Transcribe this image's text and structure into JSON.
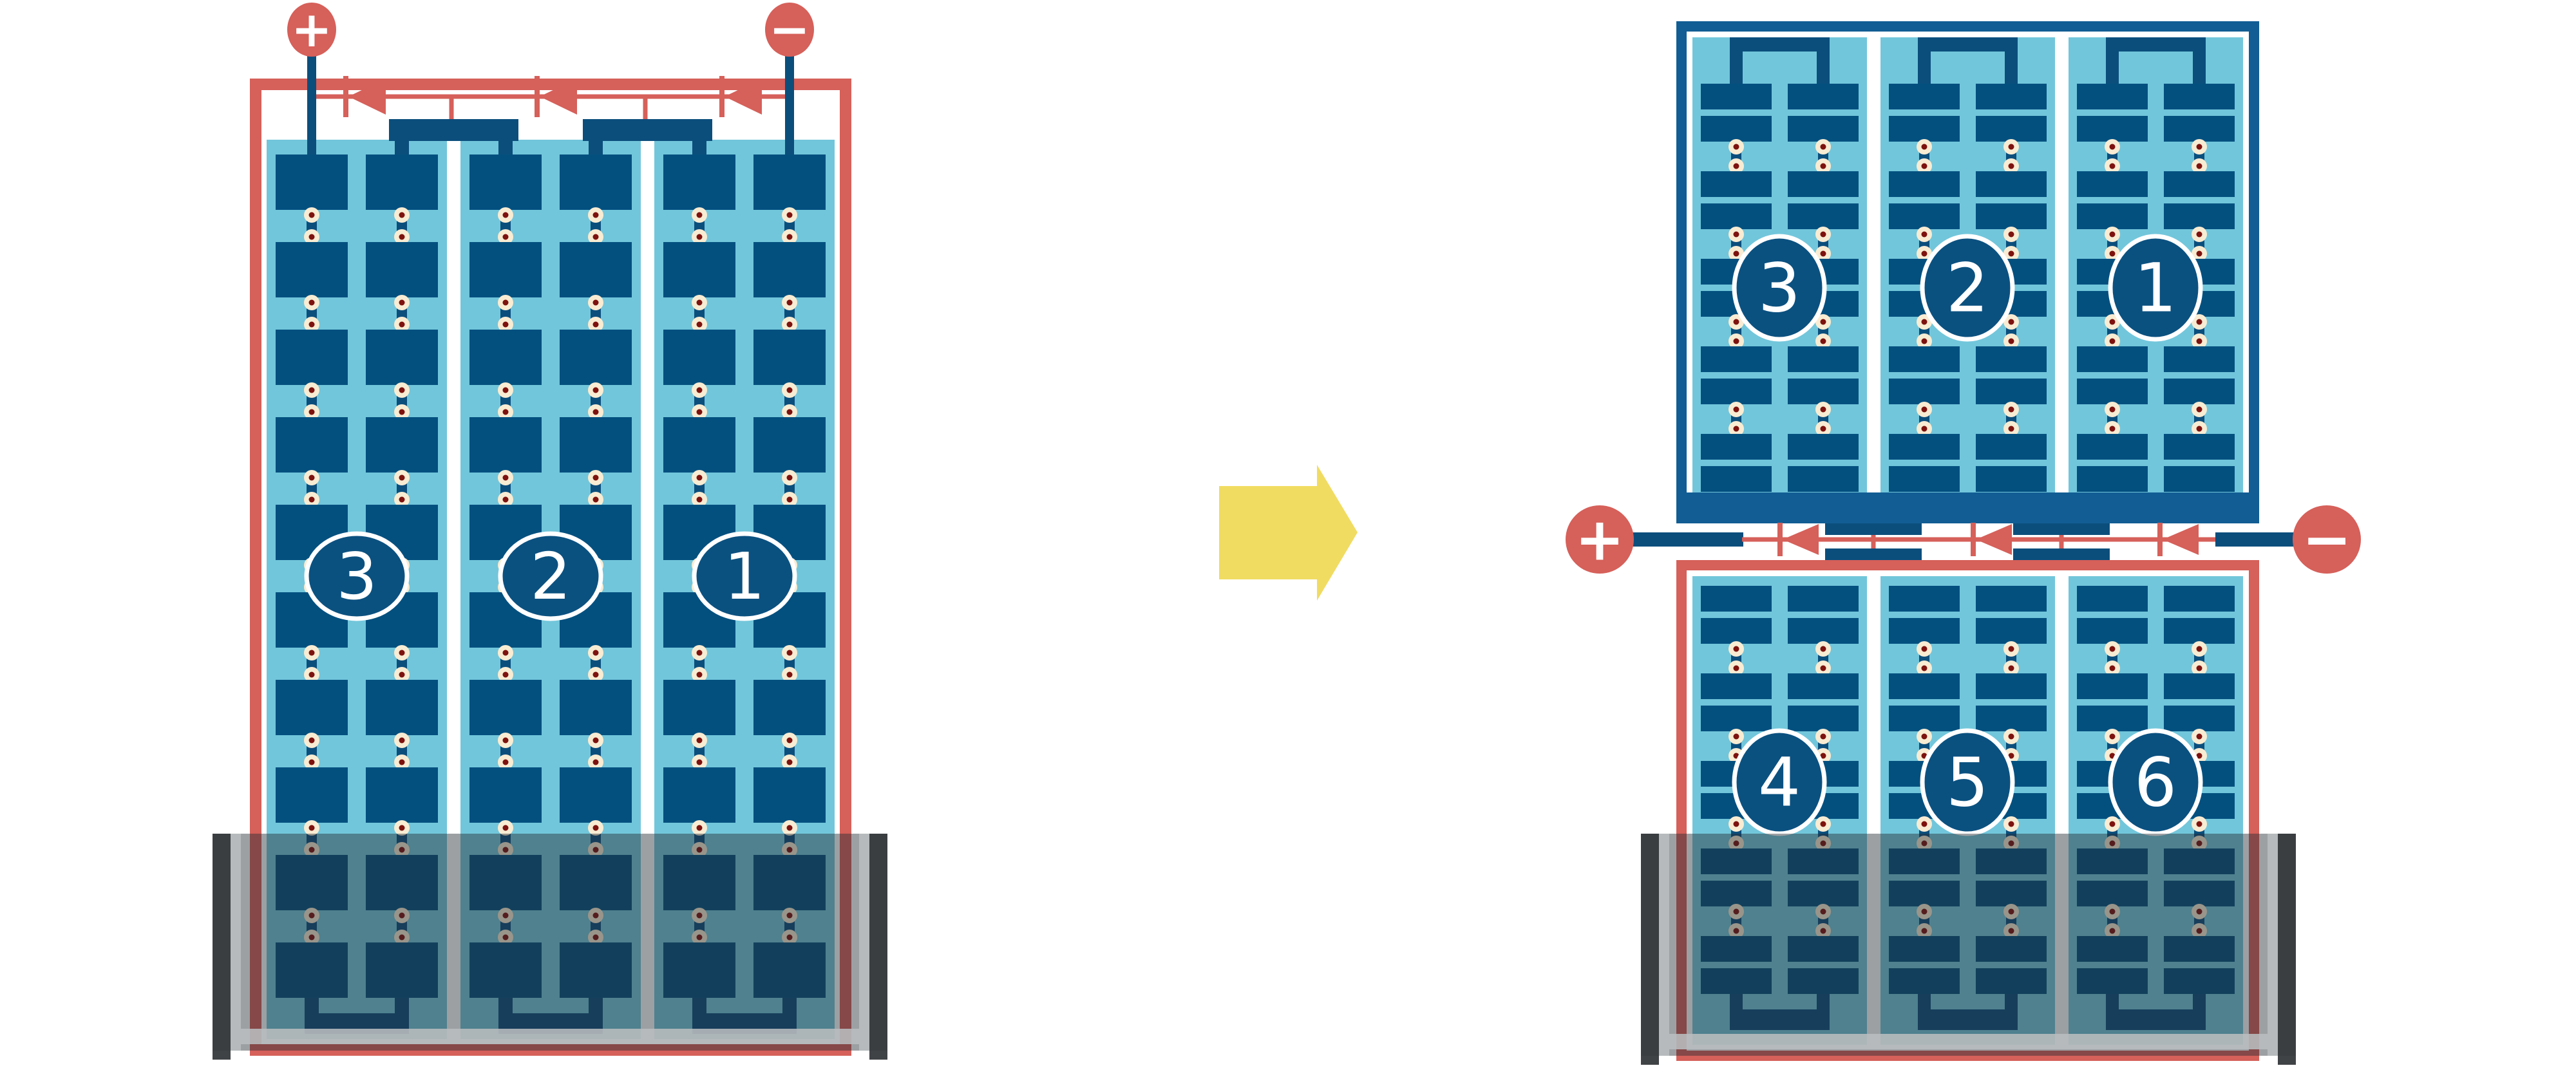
{
  "colors": {
    "background": "#ffffff",
    "wire_red": "#D6605A",
    "cell_navy": "#03507F",
    "connector_navy": "#0B4E7C",
    "frame_blue": "#125D94",
    "panel_blue": "#72C6DB",
    "separator_white": "#FFFFFF",
    "solder_cream": "#F8ECD3",
    "solder_core": "#7D120E",
    "arrow_yellow": "#F1DC62",
    "shade": "rgba(38,44,52,0.45)",
    "shade_cap": "rgba(54,57,60,0.95)",
    "shade_rail": "rgba(186,189,191,0.88)",
    "label_circle_fill": "#0B5180",
    "label_circle_ring": "#FFFFFF"
  },
  "left_module": {
    "terminals": [
      {
        "polarity": "+"
      },
      {
        "polarity": "−"
      }
    ],
    "strings": [
      {
        "label": "3"
      },
      {
        "label": "2"
      },
      {
        "label": "1"
      }
    ],
    "rows_per_string": 10,
    "half_cells_per_row": 2,
    "bypass_diodes": 3,
    "shaded_rows": 2
  },
  "right_module": {
    "terminals": [
      {
        "polarity": "+"
      },
      {
        "polarity": "−"
      }
    ],
    "bypass_diodes": 3,
    "top_panel": {
      "strings": [
        {
          "label": "3"
        },
        {
          "label": "2"
        },
        {
          "label": "1"
        }
      ],
      "row_pairs": 5
    },
    "bottom_panel": {
      "strings": [
        {
          "label": "4"
        },
        {
          "label": "5"
        },
        {
          "label": "6"
        }
      ],
      "row_pairs": 5,
      "shaded_row_pairs": 2
    }
  }
}
